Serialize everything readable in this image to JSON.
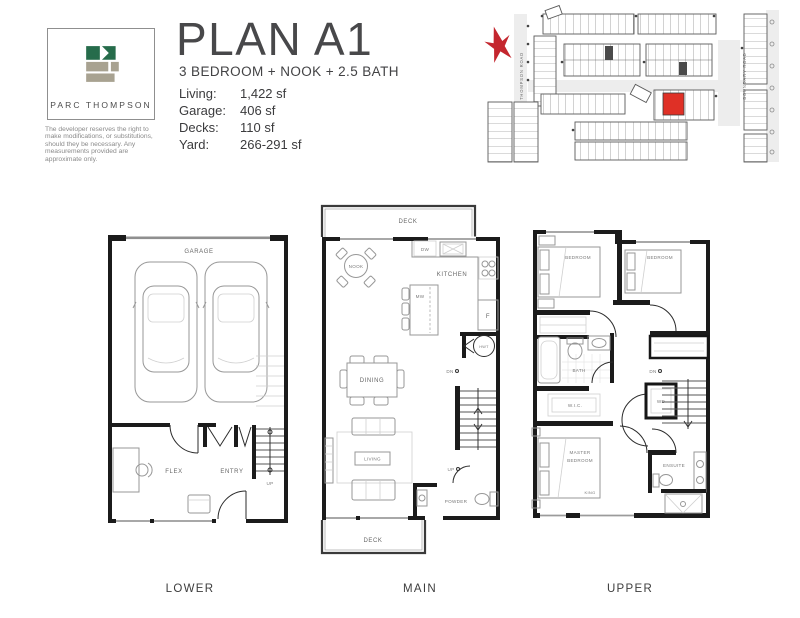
{
  "header": {
    "logo_name": "PARC THOMPSON",
    "disclaimer": "The developer reserves the right to make modifications, or substitutions, should they be necessary.  Any measurements provided are approximate only.",
    "title": "PLAN A1",
    "subtitle": "3 BEDROOM + NOOK + 2.5 BATH",
    "stats": [
      {
        "label": "Living:",
        "value": "1,422 sf"
      },
      {
        "label": "Garage:",
        "value": "406 sf"
      },
      {
        "label": "Decks:",
        "value": "110 sf"
      },
      {
        "label": "Yard:",
        "value": "266-291 sf"
      }
    ]
  },
  "colors": {
    "logo_green": "#266C4B",
    "logo_tan": "#A8A291",
    "highlight_red": "#DF3026",
    "compass_red": "#C4262E",
    "wall_black": "#1B1B1B"
  },
  "sitemap": {
    "road_left": "THOMPSON ROAD",
    "road_right": "BOUNDARY ROAD"
  },
  "plans": {
    "lower": {
      "label": "LOWER",
      "garage": "GARAGE",
      "flex": "FLEX",
      "entry": "ENTRY",
      "up": "UP"
    },
    "main": {
      "label": "MAIN",
      "deck_top": "DECK",
      "nook": "NOOK",
      "dw": "DW",
      "kitchen": "KITCHEN",
      "mw": "MW",
      "f": "F",
      "hwt": "HWT",
      "dn": "DN",
      "dining": "DINING",
      "living": "LIVING",
      "up": "UP",
      "powder": "POWDER",
      "deck_bottom": "DECK"
    },
    "upper": {
      "label": "UPPER",
      "bedroom_left": "BEDROOM",
      "bedroom_right": "BEDROOM",
      "bath": "BATH",
      "wic": "W.I.C.",
      "wd": "WD",
      "dn": "DN",
      "master_line1": "MASTER",
      "master_line2": "BEDROOM",
      "king": "KING",
      "ensuite": "ENSUITE"
    }
  }
}
